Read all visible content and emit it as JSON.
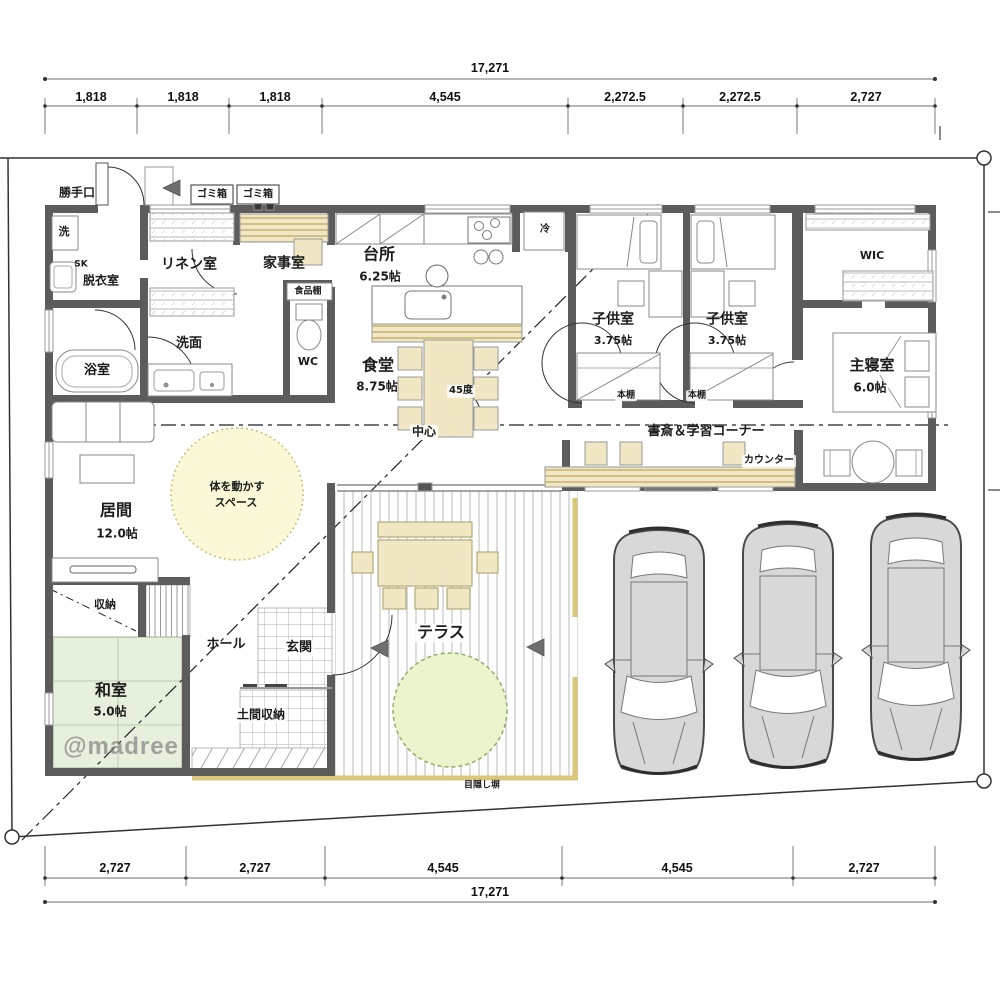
{
  "watermark": "@madree",
  "dimensions": {
    "top": {
      "total": "17,271",
      "segments": [
        "1,818",
        "1,818",
        "1,818",
        "4,545",
        "2,272.5",
        "2,272.5",
        "2,727"
      ]
    },
    "bottom": {
      "total": "17,271",
      "segments": [
        "2,727",
        "2,727",
        "4,545",
        "4,545",
        "2,727"
      ]
    }
  },
  "rooms": {
    "kitchen": {
      "label": "台所",
      "size": "6.25帖"
    },
    "dining": {
      "label": "食堂",
      "size": "8.75帖"
    },
    "living": {
      "label": "居間",
      "size": "12.0帖"
    },
    "washitsu": {
      "label": "和室",
      "size": "5.0帖"
    },
    "kids1": {
      "label": "子供室",
      "size": "3.75帖"
    },
    "kids2": {
      "label": "子供室",
      "size": "3.75帖"
    },
    "master": {
      "label": "主寝室",
      "size": "6.0帖"
    },
    "wic": {
      "label": "WIC"
    },
    "wc": {
      "label": "WC"
    },
    "bath": {
      "label": "浴室"
    },
    "washroom": {
      "label": "洗面"
    },
    "linen": {
      "label": "リネン室"
    },
    "utility": {
      "label": "家事室"
    },
    "dressing": {
      "label": "脱衣室"
    },
    "laundry": {
      "label": "洗"
    },
    "slop_sink": {
      "label": "SK"
    },
    "storage": {
      "label": "収納"
    },
    "hall": {
      "label": "ホール"
    },
    "entrance": {
      "label": "玄関"
    },
    "doma": {
      "label": "土間収納"
    },
    "terrace": {
      "label": "テラス"
    }
  },
  "annotations": {
    "back_door": "勝手口",
    "trash1": "ゴミ箱",
    "trash2": "ゴミ箱",
    "fridge": "冷",
    "pantry": "食品棚",
    "bookshelf1": "本棚",
    "bookshelf2": "本棚",
    "study_corner": "書斎＆学習コーナー",
    "counter": "カウンター",
    "exercise_line1": "体を動かす",
    "exercise_line2": "スペース",
    "angle": "45度",
    "center_mark": "中心",
    "privacy_fence": "目隠し塀"
  },
  "colors": {
    "wall": "#5c5c5c",
    "furniture_tan": "#f1e7c4",
    "tatami_green": "#e6f0dc",
    "exercise_yellow": "#fbf8d8",
    "tree_green": "#ebf5cd",
    "fence_tan": "#d9c87c",
    "car_gray": "#d8d8d8"
  }
}
